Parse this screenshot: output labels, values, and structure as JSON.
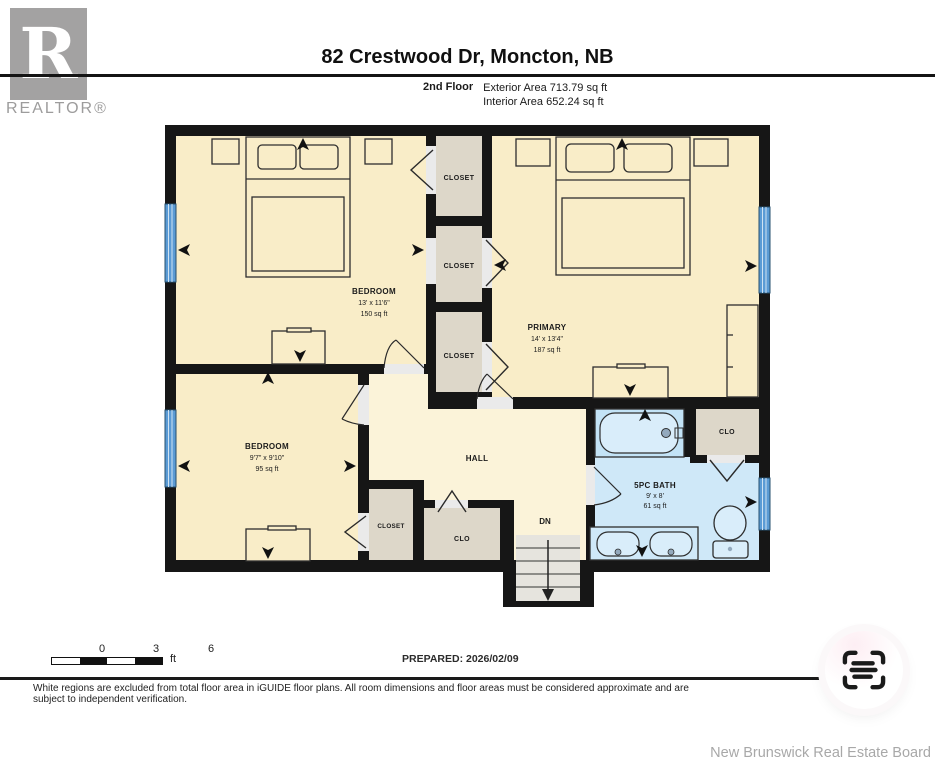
{
  "header": {
    "logo": {
      "letter": "R",
      "label": "REALTOR®"
    },
    "title": "82 Crestwood Dr, Moncton, NB",
    "floor": "2nd Floor",
    "exterior_area": "Exterior Area 713.79 sq ft",
    "interior_area": "Interior Area 652.24 sq ft"
  },
  "plan": {
    "bedroom1": {
      "name": "BEDROOM",
      "dims": "13' x 11'6\"",
      "area": "150 sq ft"
    },
    "primary": {
      "name": "PRIMARY",
      "dims": "14' x 13'4\"",
      "area": "187 sq ft"
    },
    "bedroom2": {
      "name": "BEDROOM",
      "dims": "9'7\" x 9'10\"",
      "area": "95 sq ft"
    },
    "bath": {
      "name": "5PC BATH",
      "dims": "9' x 8'",
      "area": "61 sq ft"
    },
    "hall": {
      "name": "HALL"
    },
    "stairs": {
      "label": "DN"
    },
    "closets": {
      "c1": "CLOSET",
      "c2": "CLOSET",
      "c3": "CLOSET",
      "c4": "CLOSET",
      "clo_hall": "CLO",
      "clo_bath": "CLO"
    },
    "colors": {
      "room_floor": "#f9edc8",
      "hall_floor": "#fbf3d9",
      "closet_floor": "#ddd7c9",
      "bath_floor": "#cfe8f8",
      "wall": "#161616",
      "window": "#5b9bd5"
    }
  },
  "footer": {
    "scale_ticks": [
      "0",
      "3",
      "6"
    ],
    "scale_unit": "ft",
    "prepared": "PREPARED: 2026/02/09",
    "disclaimer": "White regions are excluded from total floor area in iGUIDE floor plans. All room dimensions and floor areas must be considered approximate and are subject to independent verification.",
    "board": "New Brunswick Real Estate Board"
  }
}
